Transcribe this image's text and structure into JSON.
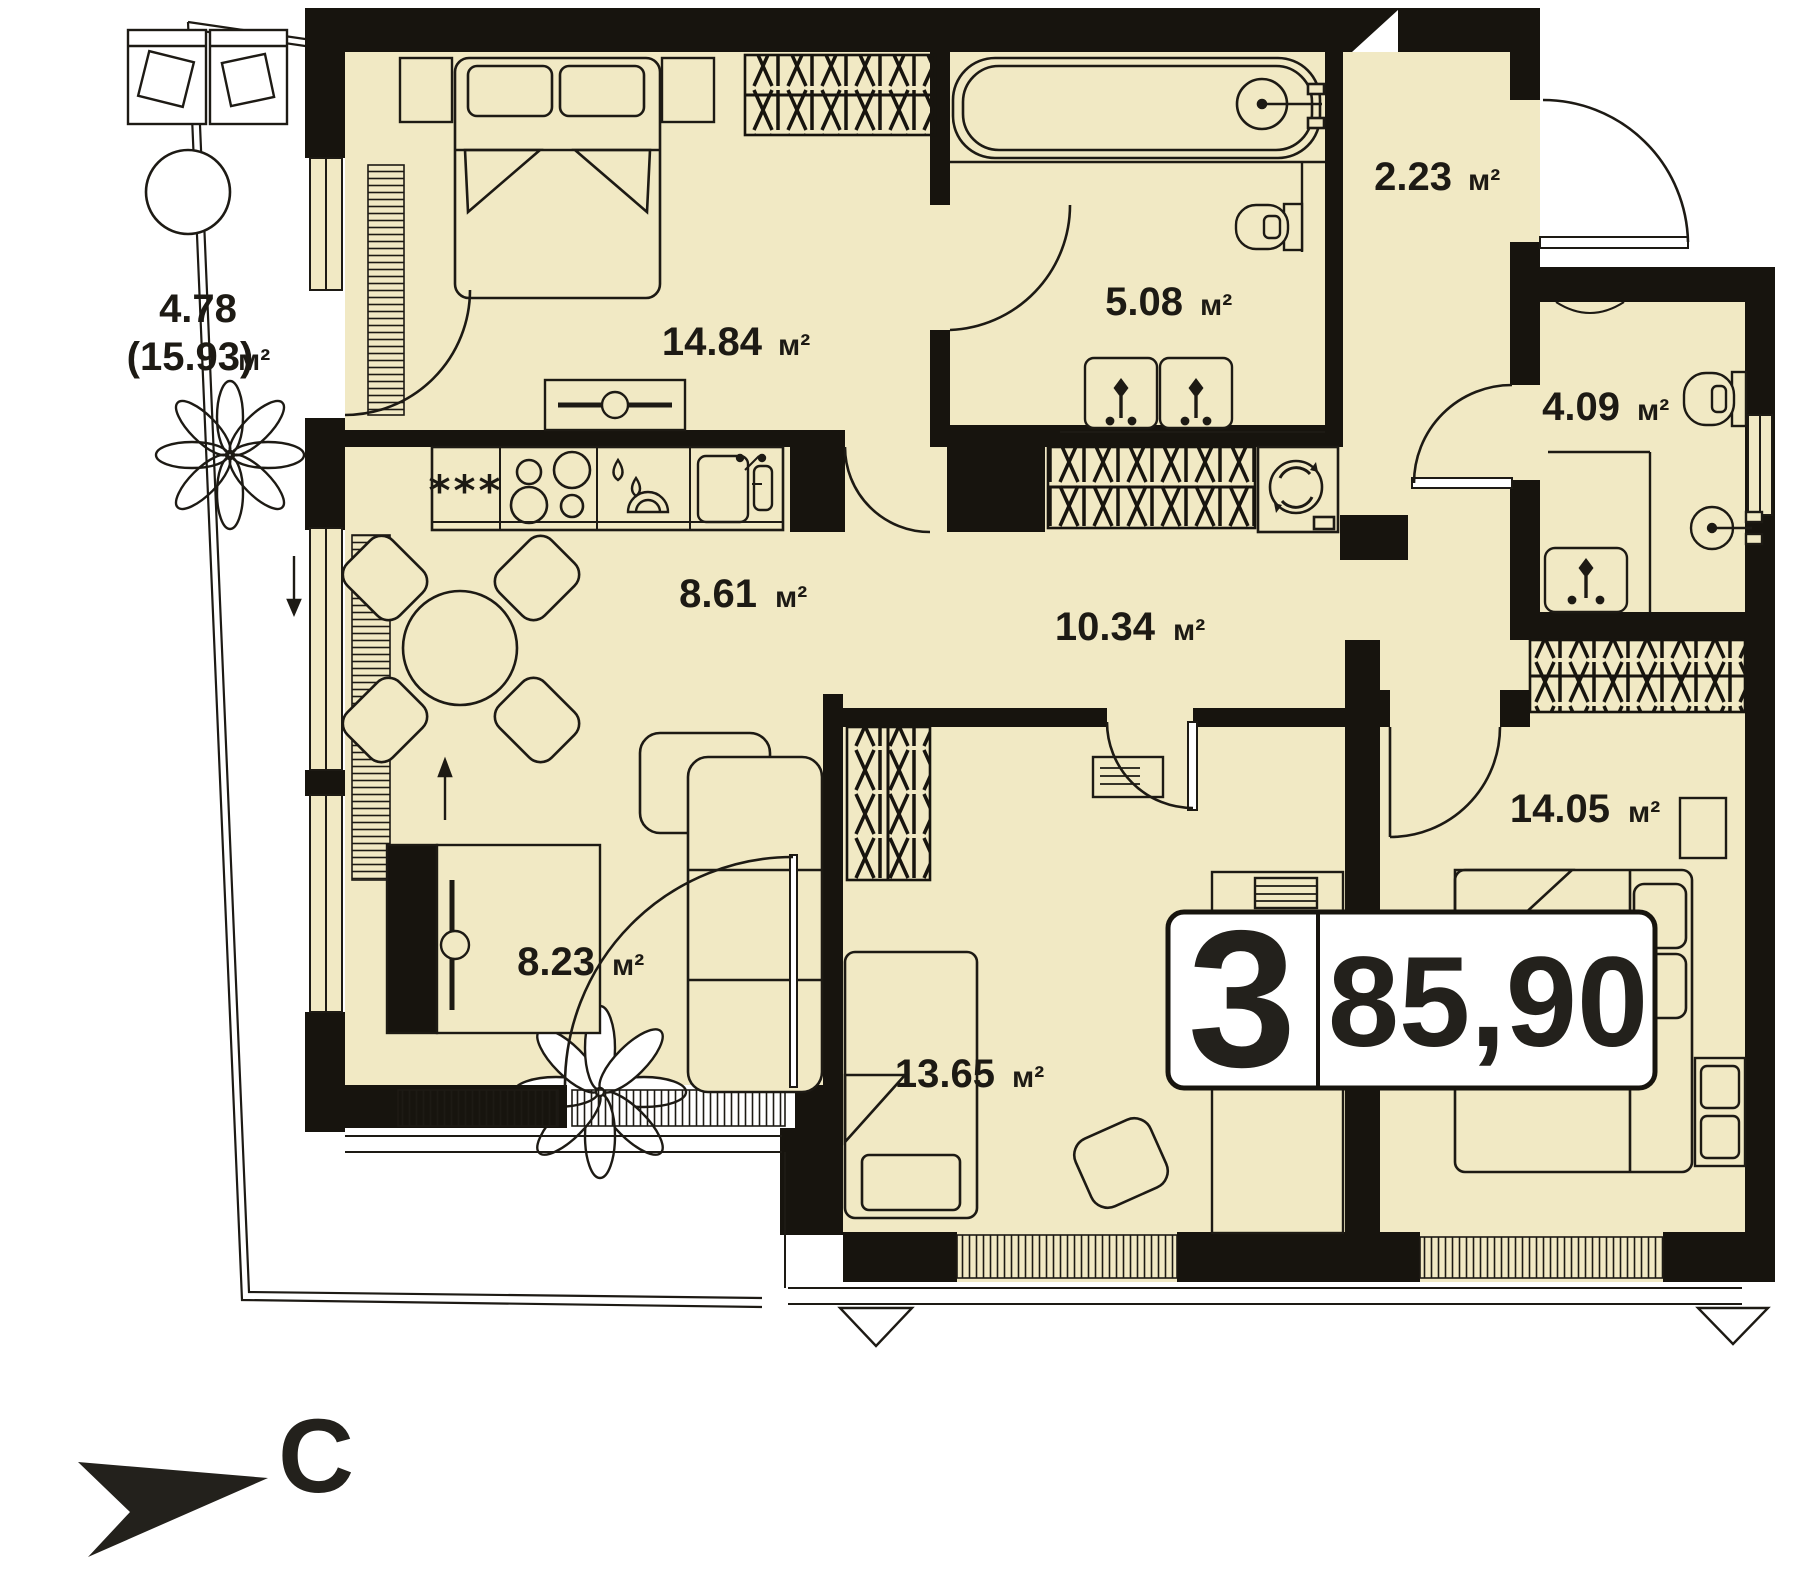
{
  "plan": {
    "title": "apartment-floor-plan",
    "colors": {
      "floor": "#f1e9c4",
      "wall": "#17140e",
      "line": "#1d1a14",
      "paper": "#ffffff"
    },
    "units": {
      "sq": "м²"
    },
    "rooms": [
      {
        "name": "bedroom",
        "area": "14.84"
      },
      {
        "name": "bathroom",
        "area": "5.08"
      },
      {
        "name": "entry-hall",
        "area": "2.23"
      },
      {
        "name": "wc",
        "area": "4.09"
      },
      {
        "name": "kitchen",
        "area": "8.61"
      },
      {
        "name": "hallway",
        "area": "10.34"
      },
      {
        "name": "living",
        "area": "8.23"
      },
      {
        "name": "kids-room",
        "area": "13.65"
      },
      {
        "name": "bedroom-2",
        "area": "14.05"
      }
    ],
    "balcony": {
      "area": "4.78",
      "area_total": "(15.93)"
    },
    "badge": {
      "rooms_count": "3",
      "total_area": "85,90"
    },
    "compass": {
      "north_label": "С"
    },
    "kitchen": {
      "fridge_symbol": "***"
    }
  }
}
